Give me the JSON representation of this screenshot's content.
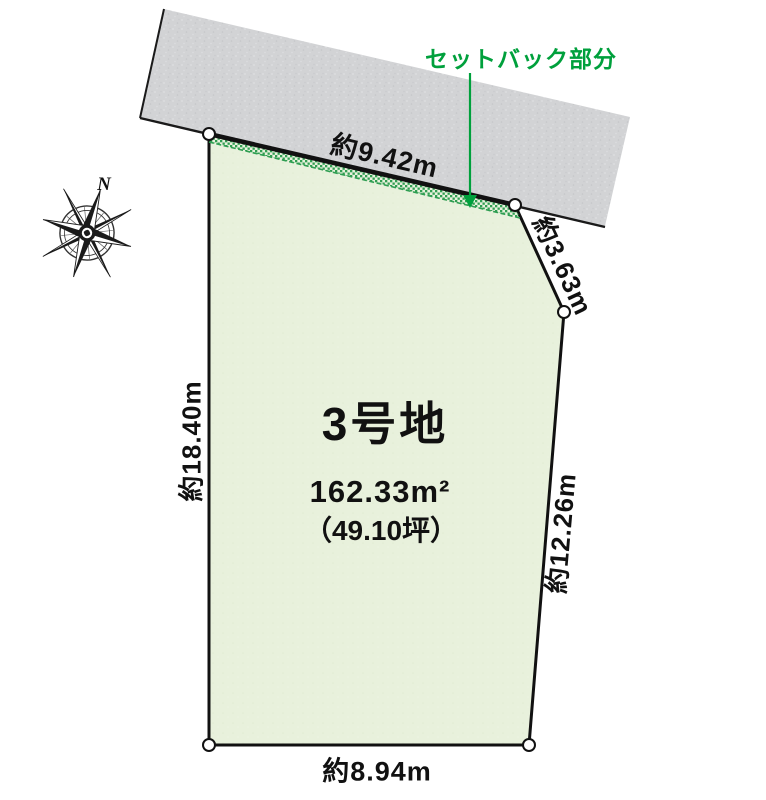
{
  "diagram": {
    "type": "land-plot-diagram",
    "plot": {
      "title": "3号地",
      "area_m2": "162.33m²",
      "area_tsubo": "（49.10坪）"
    },
    "dimensions": {
      "top": "約9.42m",
      "diagonal_top_right": "約3.63m",
      "right": "約12.26m",
      "left": "約18.40m",
      "bottom": "約8.94m"
    },
    "setback": {
      "label": "セットバック部分"
    },
    "compass": {
      "north_label": "N"
    },
    "colors": {
      "plot_fill": "#e8f1dc",
      "road_fill": "#d2d3d5",
      "setback_green": "#2f9e52",
      "annotation_green": "#00a03c",
      "outline_black": "#111111"
    }
  }
}
